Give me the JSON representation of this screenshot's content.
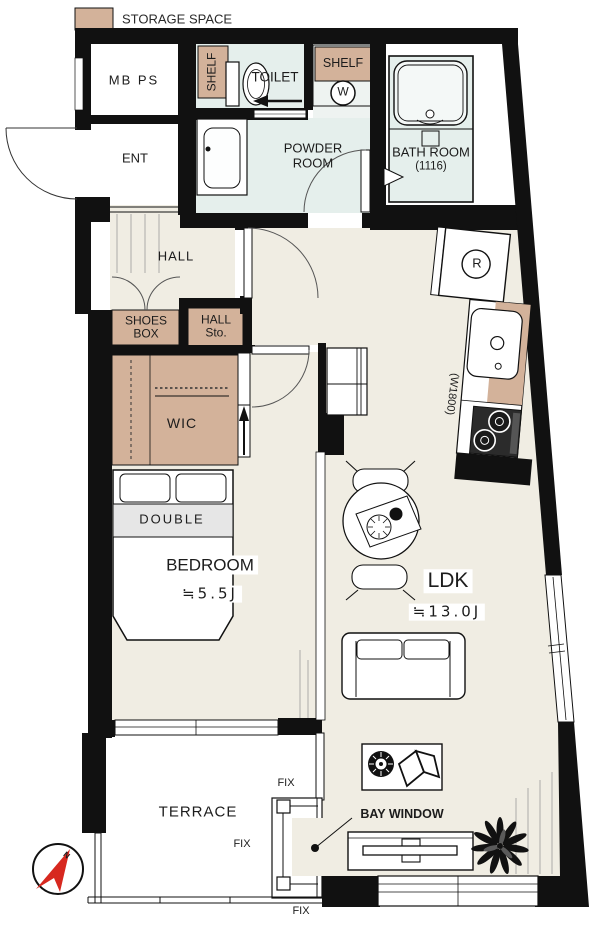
{
  "legend": {
    "label": "STORAGE SPACE",
    "swatch_color": "#d3b29a"
  },
  "rooms": {
    "mbps": "MB PS",
    "ent": "ENT",
    "toilet": "TOILET",
    "powder_line1": "POWDER",
    "powder_line2": "ROOM",
    "bath_line1": "BATH ROOM",
    "bath_line2": "(1116)",
    "hall": "HALL",
    "shoes_line1": "SHOES",
    "shoes_line2": "BOX",
    "hallsto_line1": "HALL",
    "hallsto_line2": "Sto.",
    "wic": "WIC",
    "bedroom_name": "BEDROOM",
    "bedroom_area": "≒5.5J",
    "ldk_name": "LDK",
    "ldk_area": "≒13.0J",
    "terrace": "TERRACE"
  },
  "fixtures": {
    "shelf_toilet": "SHELF",
    "shelf_laundry": "SHELF",
    "washer_mark": "W",
    "fridge_mark": "R",
    "kitchen_width": "(W1800)",
    "bed_type": "DOUBLE",
    "bay_window_label": "BAY WINDOW",
    "north_mark": "N"
  },
  "windows": {
    "fix_labels": [
      "FIX",
      "FIX",
      "FIX"
    ]
  },
  "colors": {
    "wall": "#111111",
    "storage": "#d3b29a",
    "wet_area": "#e5efec",
    "floor": "#f0ede3",
    "bed_band": "#e6e6e6",
    "compass_red": "#d7281f"
  }
}
